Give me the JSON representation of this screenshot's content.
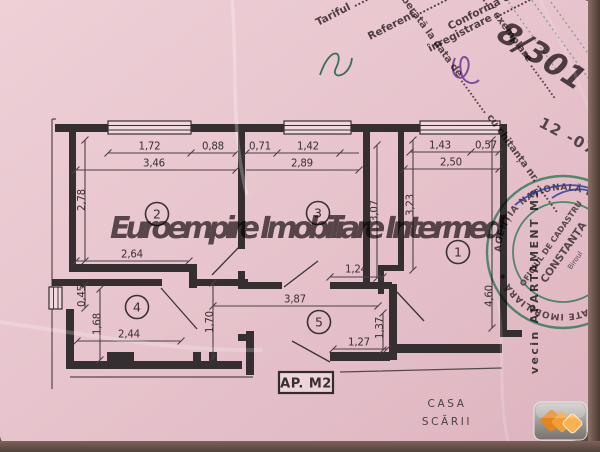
{
  "paper_color": "#e9c8d0",
  "ink_color": "#372f32",
  "watermark": {
    "text": "Euroempire Imobiliare Intermed",
    "color": "#9c3028"
  },
  "plan": {
    "room_numbers": [
      "1",
      "2",
      "3",
      "4",
      "5"
    ],
    "labels": {
      "apartment": "AP. M2",
      "staircase_line1": "CASA",
      "staircase_line2": "SCĂRII",
      "neighbor": "vecin APARTAMENT M3"
    },
    "dimensions": {
      "room2": {
        "segment1": "1,72",
        "segment2": "0,88",
        "width": "3,46",
        "height": "2,78",
        "bottom_wall": "2,64"
      },
      "room3": {
        "segment1": "0,71",
        "segment2": "1,42",
        "width": "2,89",
        "height": "3,07"
      },
      "room1": {
        "segment1": "1,43",
        "segment2": "0,57",
        "width": "2,50",
        "height_left": "3,23",
        "height_right": "4,60"
      },
      "room4": {
        "side_window": "0,45",
        "height": "1,68",
        "width": "2,44"
      },
      "hallway": {
        "width": "3,87",
        "height": "1,70",
        "niche_width": "1,24",
        "entry_height": "1,37",
        "entry_width": "1,27"
      }
    }
  },
  "stamps": {
    "green_color": "#2f9e6a",
    "diagonal_primary": [
      "înregistrare ................ ziua ..........",
      "Conformă cu originalul ..............",
      "Tariful .......................",
      "Referent ...................."
    ],
    "diagonal_secondary": [
      "eliberată la data de ........... cu chitanța nr. .........",
      "........... / exemplare ..........."
    ],
    "date": "12 -07-",
    "round": {
      "ring": "AGENȚIA NAȚIONALĂ DE CADASTRU ȘI PUBLICITATE IMOBILIARĂ ★",
      "office": "OFICIUL DE CADASTRU",
      "city": "CONSTANȚA",
      "bureau": "Biroul"
    }
  },
  "handwriting": {
    "registry_number": "8/301",
    "color": "#6b3cae"
  }
}
